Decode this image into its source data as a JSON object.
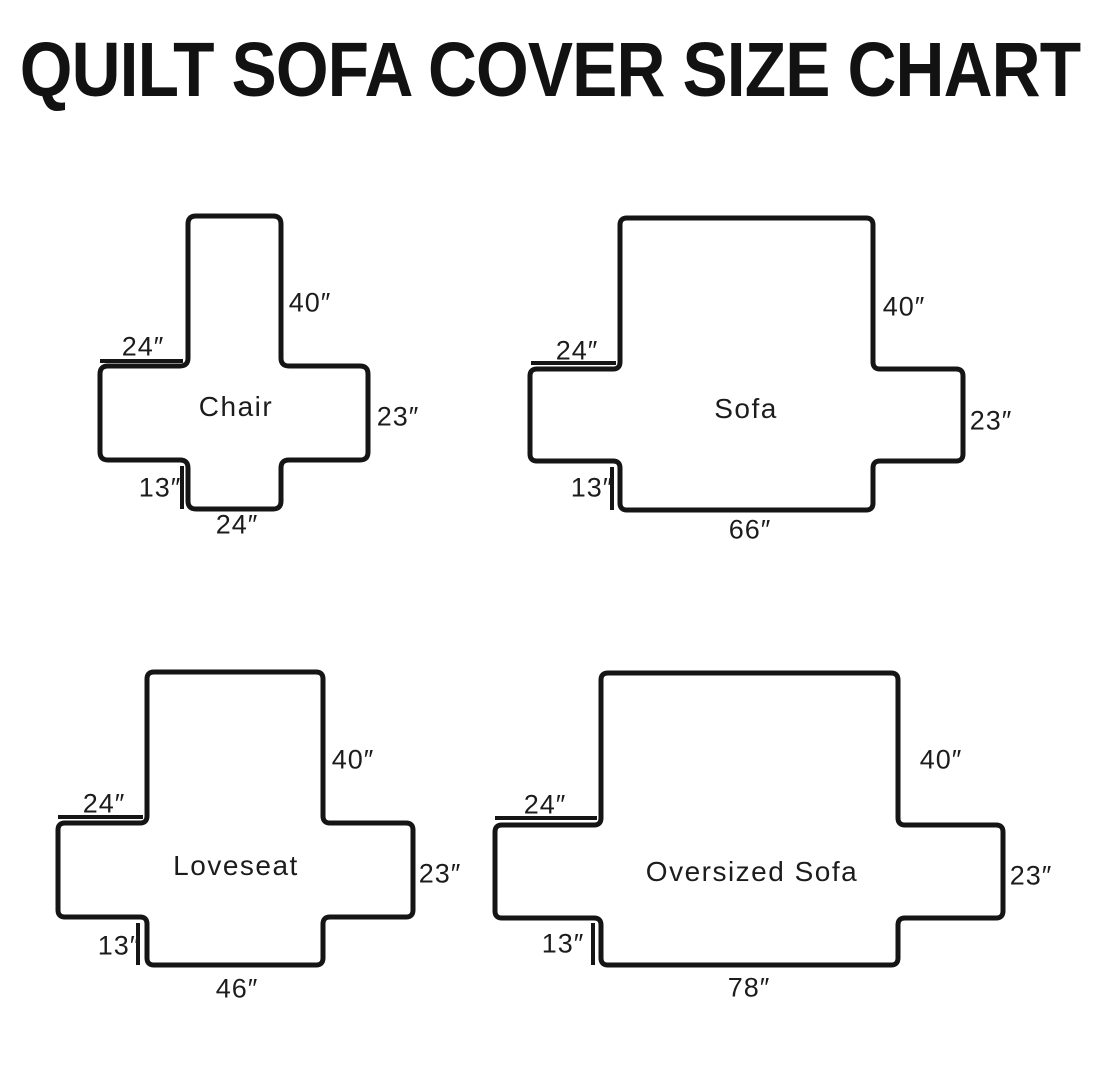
{
  "title": "QUILT SOFA COVER SIZE CHART",
  "colors": {
    "line": "#151515",
    "background": "#ffffff",
    "text": "#1c1c1c"
  },
  "diagrams": [
    {
      "name": "Chair",
      "back_height": "40″",
      "arm_top_width": "24″",
      "arm_side_height": "23″",
      "front_skirt_drop": "13″",
      "bottom_width": "24″"
    },
    {
      "name": "Sofa",
      "back_height": "40″",
      "arm_top_width": "24″",
      "arm_side_height": "23″",
      "front_skirt_drop": "13″",
      "bottom_width": "66″"
    },
    {
      "name": "Loveseat",
      "back_height": "40″",
      "arm_top_width": "24″",
      "arm_side_height": "23″",
      "front_skirt_drop": "13″",
      "bottom_width": "46″"
    },
    {
      "name": "Oversized Sofa",
      "back_height": "40″",
      "arm_top_width": "24″",
      "arm_side_height": "23″",
      "front_skirt_drop": "13″",
      "bottom_width": "78″"
    }
  ]
}
